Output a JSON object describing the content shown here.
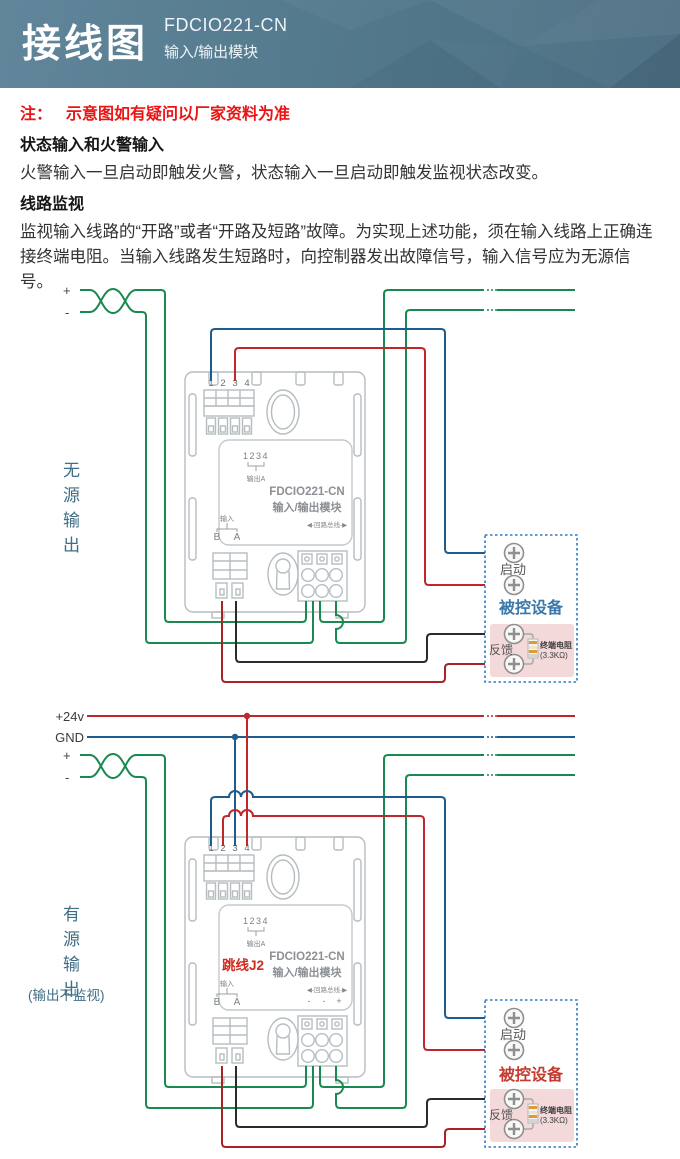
{
  "header": {
    "title": "接线图",
    "model": "FDCIO221-CN",
    "subtitle": "输入/输出模块"
  },
  "note": {
    "prefix": "注：",
    "text": "示意图如有疑问以厂家资料为准"
  },
  "sec1": {
    "heading": "状态输入和火警输入",
    "body": "火警输入一旦启动即触发火警，状态输入一旦启动即触发监视状态改变。"
  },
  "sec2": {
    "heading": "线路监视",
    "body": "监视输入线路的“开路”或者“开路及短路”故障。为实现上述功能，须在输入线路上正确连接终端电阻。当输入线路发生短路时，向控制器发出故障信号，输入信号应为无源信号。"
  },
  "power": {
    "v24": "+24v",
    "gnd": "GND"
  },
  "d1": {
    "side": "无源输出",
    "plus": "+",
    "minus": "-",
    "module": {
      "t1": "1",
      "t2": "2",
      "t3": "3",
      "t4": "4",
      "mini": "1234",
      "out": "输出A",
      "model": "FDCIO221-CN",
      "name": "输入/输出模块",
      "input": "输入",
      "b": "B",
      "a": "A",
      "bus": "◀-回路总线-▶"
    },
    "device": {
      "title": "被控设备",
      "start": "启动",
      "feedback": "反馈",
      "res_name": "终端电阻",
      "res_value": "(3.3KΩ)"
    }
  },
  "d2": {
    "side": "有源输出",
    "side_sub": "(输出不监视)",
    "plus": "+",
    "minus": "-",
    "jumper": "跳线J2",
    "module": {
      "t1": "1",
      "t2": "2",
      "t3": "3",
      "t4": "4",
      "mini": "1234",
      "out": "输出A",
      "model": "FDCIO221-CN",
      "name": "输入/输出模块",
      "input": "输入",
      "b": "B",
      "a": "A",
      "bus": "◀-回路总线-▶",
      "neg1": "-",
      "neg2": "-",
      "pos": "+"
    },
    "device": {
      "title": "被控设备",
      "start": "启动",
      "feedback": "反馈",
      "res_name": "终端电阻",
      "res_value": "(3.3KΩ)"
    }
  },
  "colors": {
    "wire_green": "#188a4f",
    "wire_blue": "#1f5c8e",
    "wire_red": "#c0272b",
    "wire_black": "#2b2b2b",
    "wire_dark_red": "#a82323",
    "device_title_passive": "#3a78ab",
    "device_title_active": "#c43b30",
    "device_border": "#2e7bc0",
    "feedback_panel": "#f3d9d9",
    "module_outline": "#b6bdc1",
    "header_bg": "#547a8e",
    "note_red": "#ea1414",
    "side_label": "#3f6e86",
    "jumper_red": "#cf2b20"
  }
}
